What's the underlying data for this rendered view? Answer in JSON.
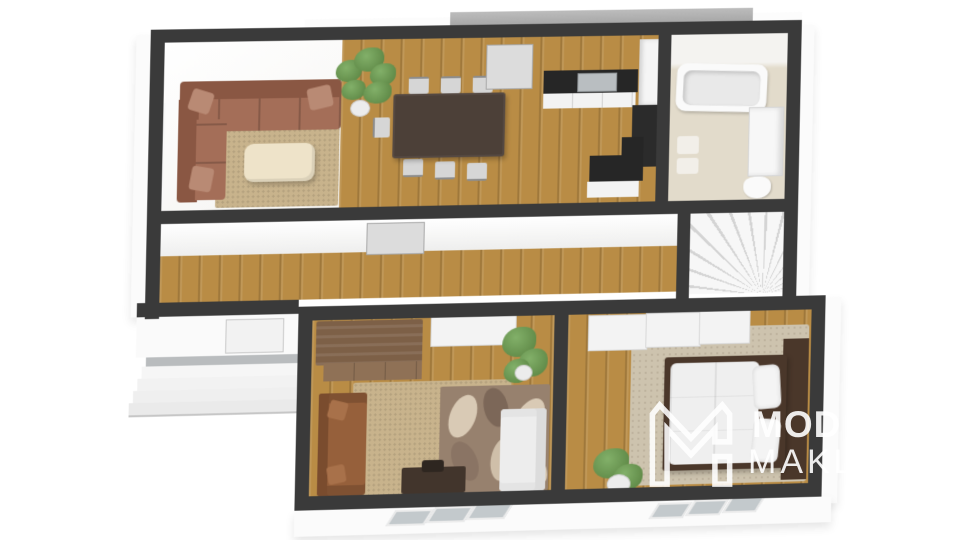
{
  "meta": {
    "kind": "3d-floorplan-render",
    "width": 960,
    "height": 540,
    "background": "#ffffff"
  },
  "watermark": {
    "logo": "m-monogram-icon",
    "line1": "MOD",
    "line2": "MAKL",
    "color": "#ffffff"
  },
  "colors": {
    "wall": "#3a3a3a",
    "wood": "#b98c45",
    "rug_beige": "#c8b38c",
    "bath_floor": "#e2dbcb",
    "roof_gray": "#a5a5a5",
    "skirt_white": "#fbfbfb",
    "sofa_terracotta": "#a46e58",
    "sofa_terracotta_dark": "#8a5743",
    "pillow_terracotta": "#b98a74",
    "sofa_brown": "#96603b",
    "sofa_brown_dark": "#7a4c2e",
    "table_dark": "#4c4038",
    "cream": "#eee3c9",
    "counter_dark": "#262626",
    "bed_frame": "#4a372a",
    "plant_green": "#567f3e",
    "floral_base": "#97816e",
    "petal_light": "#d9cab5",
    "petal_dark": "#7c6758",
    "bedroom_rug": "#cdc3ae",
    "watermark_color": "#ffffff"
  },
  "rooms": [
    {
      "id": "living-dining-room",
      "contents": [
        "corner-sofa",
        "coffee-table",
        "area-rug",
        "potted-plant",
        "dining-table",
        "dining-chairs",
        "rear-door",
        "side-window"
      ]
    },
    {
      "id": "kitchen",
      "contents": [
        "counter-with-sink",
        "tall-cabinets",
        "oven-tower",
        "l-shaped-counter"
      ]
    },
    {
      "id": "bathroom",
      "contents": [
        "bathtub",
        "vanity",
        "toilet",
        "bath-mats"
      ]
    },
    {
      "id": "hallway",
      "contents": [
        "interior-door"
      ]
    },
    {
      "id": "stair-room",
      "contents": [
        "winder-staircase"
      ]
    },
    {
      "id": "study",
      "contents": [
        "wood-wardrobe",
        "white-sideboard",
        "brown-sofa",
        "jute-rug",
        "floral-rug",
        "desk",
        "white-armchair",
        "plants"
      ]
    },
    {
      "id": "bedroom",
      "contents": [
        "closet-row",
        "double-bed",
        "pillows",
        "headboard-panel",
        "rug",
        "plant",
        "wood-strip"
      ]
    },
    {
      "id": "entrance",
      "contents": [
        "front-door",
        "exterior-steps",
        "landing"
      ]
    }
  ]
}
